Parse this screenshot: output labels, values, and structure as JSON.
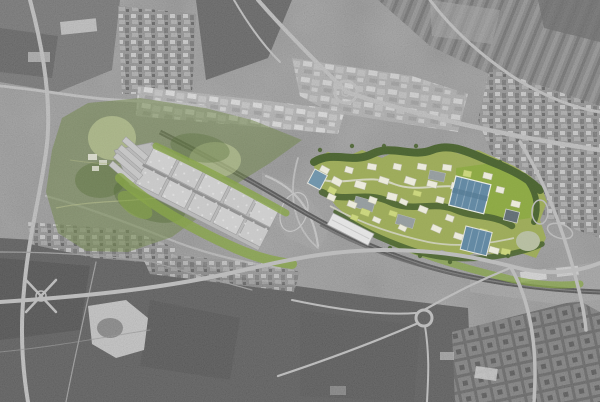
{
  "window": {
    "width": 600,
    "height": 402
  },
  "map": {
    "type": "grayscale-aerial-photograph-with-masterplan-overlay",
    "regions": [
      "existing-park-west",
      "logistics-warehouse-complex",
      "masterplan-campus-east",
      "railway-corridor",
      "central-motorway-interchange",
      "south-highway",
      "residential-grid-southeast",
      "dense-town-east",
      "industrial-sheds-north",
      "farm-fields-southwest",
      "quarry-lake",
      "southeast-interchange"
    ]
  },
  "colors": {
    "base_gray": "#8c8c8c",
    "field_dark": "#4e4e4e",
    "field_mid": "#6b6b6b",
    "road_light": "#bcbcbc",
    "railway_dark": "#434343",
    "park_green": "#6e8443",
    "park_pale": "#c8d49b",
    "park_dark": "#4f6930",
    "strip_green": "#84a441",
    "campus_ground": "#9cab54",
    "campus_trees": "#46602a",
    "lawn_bright": "#8aa93c",
    "building_white": "#efeede",
    "building_yellow": "#ccd879",
    "building_gray": "#949c9e",
    "roof_blue": "#5d86a2",
    "roof_blue_dark": "#5e6b72",
    "warehouse_pad": "#b9b9b9",
    "warehouse_roof": "#d0d0d0",
    "meadow_pale": "#b7bfa0",
    "quarry_white": "#cdcdcd",
    "shed_white": "#e6e6e6"
  }
}
